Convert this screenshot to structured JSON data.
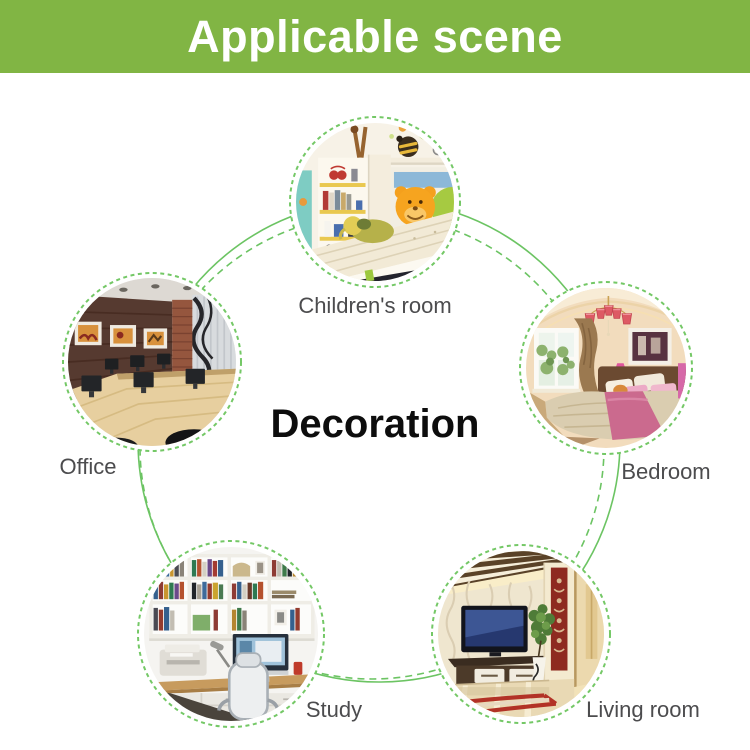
{
  "banner": {
    "title": "Applicable scene",
    "bg_color": "#81B544",
    "text_color": "#FFFFFF"
  },
  "center_title": "Decoration",
  "diagram": {
    "connector_color": "#6CC463",
    "ring_color": "#74C866",
    "label_color": "#4C4C4E",
    "nodes": [
      {
        "id": "children-room",
        "label": "Children's room"
      },
      {
        "id": "office",
        "label": "Office"
      },
      {
        "id": "bedroom",
        "label": "Bedroom"
      },
      {
        "id": "study",
        "label": "Study"
      },
      {
        "id": "living-room",
        "label": "Living room"
      }
    ]
  }
}
